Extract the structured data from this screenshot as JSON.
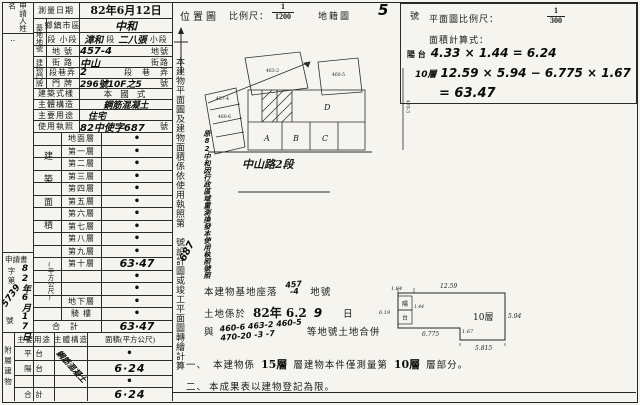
{
  "sheet": {
    "applicant_label": "申請人姓名",
    "ink_marks": "‥"
  },
  "left": {
    "r0l": "測量日期",
    "r0v": "82年6月12日",
    "g1": "基地地號",
    "r1l": "鄉鎮市區",
    "r1v": "中和",
    "r2l": "段 小段",
    "r2hw1": "漳和",
    "r2p1": "段",
    "r2hw2": "二八張",
    "r2p2": "小段",
    "r3l": "地 號",
    "r3v": "457-4",
    "r3u": "地號",
    "g2": "建物門牌",
    "r4l": "街 路",
    "r4v": "中山",
    "r4u": "街路",
    "r5l": "段巷弄",
    "r5v": "2",
    "r5u": "段　巷　弄",
    "r6l": "門 牌",
    "r6v": "296號10F之5",
    "r6u": "號",
    "r7l": "建築式樣",
    "r7v": "本 國 式",
    "r8l": "主體構造",
    "r8v": "鋼筋混凝土",
    "r9l": "主要用途",
    "r9v": "住宅",
    "r10l": "使用執照",
    "r10v": "82中使字687",
    "r10u": "號"
  },
  "floors": {
    "group": "建築面積",
    "unit": "(平方公尺)",
    "rows": [
      {
        "label": "地面層",
        "value": "•"
      },
      {
        "label": "第一層",
        "value": "•"
      },
      {
        "label": "第二層",
        "value": "•"
      },
      {
        "label": "第三層",
        "value": "•"
      },
      {
        "label": "第四層",
        "value": "•"
      },
      {
        "label": "第五層",
        "value": "•"
      },
      {
        "label": "第六層",
        "value": "•"
      },
      {
        "label": "第七層",
        "value": "•"
      },
      {
        "label": "第八層",
        "value": "•"
      },
      {
        "label": "第九層",
        "value": "•"
      },
      {
        "label": "第十層",
        "value": "63·47"
      },
      {
        "label": "",
        "value": "•"
      },
      {
        "label": "",
        "value": "•"
      },
      {
        "label": "地下層",
        "value": "•"
      },
      {
        "label": "騎 樓",
        "value": "•"
      },
      {
        "label": "合 計",
        "value": "63·47"
      }
    ]
  },
  "application": {
    "label": "申請書",
    "date": "82年6月17日",
    "prefix": "字第",
    "number": "5739",
    "suffix": "號"
  },
  "annex": {
    "side": "附屬建物",
    "h_use": "主要用途",
    "h_struct": "主體構造",
    "h_area": "面積(平方公尺)",
    "rows": [
      {
        "use": "平 台",
        "struct": "",
        "area": "•"
      },
      {
        "use": "陽 台",
        "struct": "鋼筋混凝土",
        "area": "6·24"
      },
      {
        "use": "",
        "struct": "",
        "area": "•"
      },
      {
        "use": "合 計",
        "struct": "",
        "area": "6·24"
      }
    ]
  },
  "strip": {
    "sentence": "本建物平面圖及建物面積係依使用執照第　號設計圖或竣工平面圖轉繪計算",
    "hand_number": "687",
    "hand_note": "原82中和因行政區域重測換發本使用執照號照"
  },
  "loc": {
    "title": "位置圖",
    "scale_label": "比例尺：",
    "num": "1",
    "den": "1200",
    "sheet_label": "地籍圖",
    "sheet_no": "5",
    "sheet_unit": "號",
    "road": "中山路2段",
    "pA": "A",
    "pB": "B",
    "pC": "C",
    "pD": "D",
    "tiny0": "457-4",
    "tiny1": "460-6",
    "tiny2": "463-2",
    "tiny3": "460-5",
    "tiny4": "470-3"
  },
  "plan": {
    "scale_label": "平面圖比例尺：",
    "num": "1",
    "den": "300",
    "formula_label": "面積計算式：",
    "f1p": "陽 台",
    "f1e": "4.33 × 1.44 = 6.24",
    "f2p": "10層",
    "f2e": "12.59 × 5.94 − 6.775 × 1.67",
    "f3e": "= 63.47",
    "room": "10層",
    "d_tl": "1.84",
    "d_top": "12.59",
    "d_left": "6.19",
    "d_right": "5.94",
    "d_notch_w": "6.775",
    "d_notch_h": "1.67",
    "d_bottom": "5.815",
    "d_balcony": "1.44",
    "bal1": "陽",
    "bal2": "台"
  },
  "notes": {
    "m1a": "本建物基地座落",
    "m1h1": "457",
    "m1h2": "-4",
    "m1b": "地號",
    "m2a": "土地係於",
    "m2s": "82年 6.2",
    "m2h": "9",
    "m2b": "日",
    "m3a": "與",
    "m3h1": "460-6 463-2 460-5",
    "m3h2": "470-20 -3 -7",
    "m3b": "等地號土地合併",
    "n1no": "一、",
    "n1a": "本建物係",
    "n1s1": "15層",
    "n1b": "層建物本件僅測量第",
    "n1s2": "10層",
    "n1c": "層部分。",
    "n2no": "二、",
    "n2": "本成果表以建物登記為限。"
  }
}
